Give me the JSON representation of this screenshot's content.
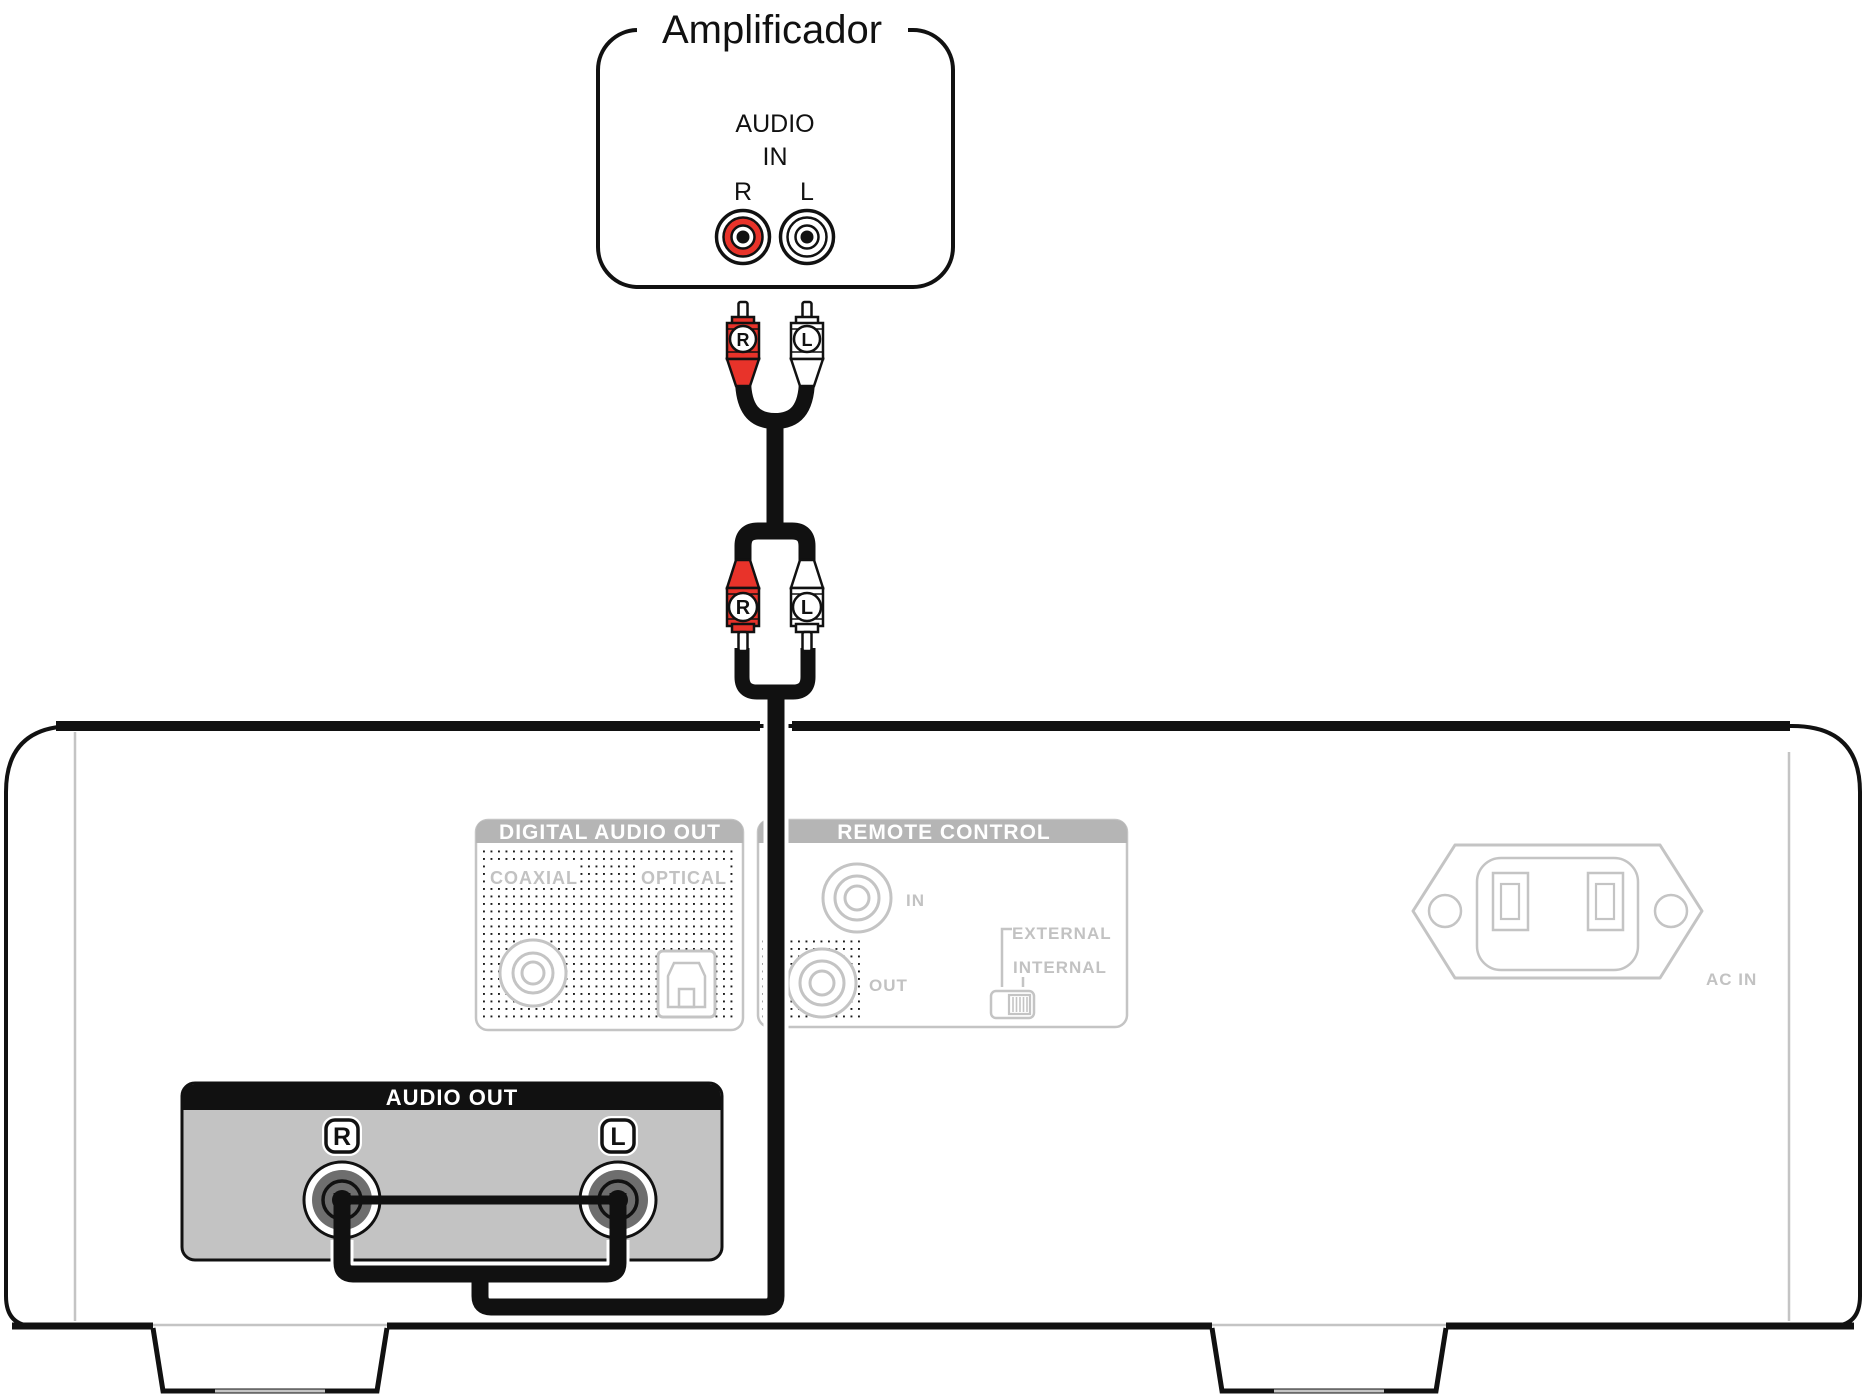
{
  "diagram_title": "Amplificador",
  "amplifier": {
    "label": "Amplificador",
    "audio_in_line1": "AUDIO",
    "audio_in_line2": "IN",
    "jack_right_label": "R",
    "jack_left_label": "L"
  },
  "cable": {
    "plug_right_label": "R",
    "plug_left_label": "L"
  },
  "rear_panel": {
    "digital_audio_out": {
      "title": "DIGITAL AUDIO OUT",
      "coaxial_label": "COAXIAL",
      "optical_label": "OPTICAL"
    },
    "remote_control": {
      "title": "REMOTE CONTROL",
      "in_label": "IN",
      "out_label": "OUT",
      "external_label": "EXTERNAL",
      "internal_label": "INTERNAL"
    },
    "ac_in_label": "AC IN",
    "audio_out": {
      "title": "AUDIO OUT",
      "jack_right_label": "R",
      "jack_left_label": "L"
    }
  },
  "colors": {
    "plug_red": "#e8332a",
    "disabled_gray": "#c2c2c2",
    "section_header_gray": "#b5b5b5",
    "audio_out_panel_gray": "#c3c3c3",
    "jack_dark_gray": "#6e6e6e",
    "line_black": "#111111"
  }
}
